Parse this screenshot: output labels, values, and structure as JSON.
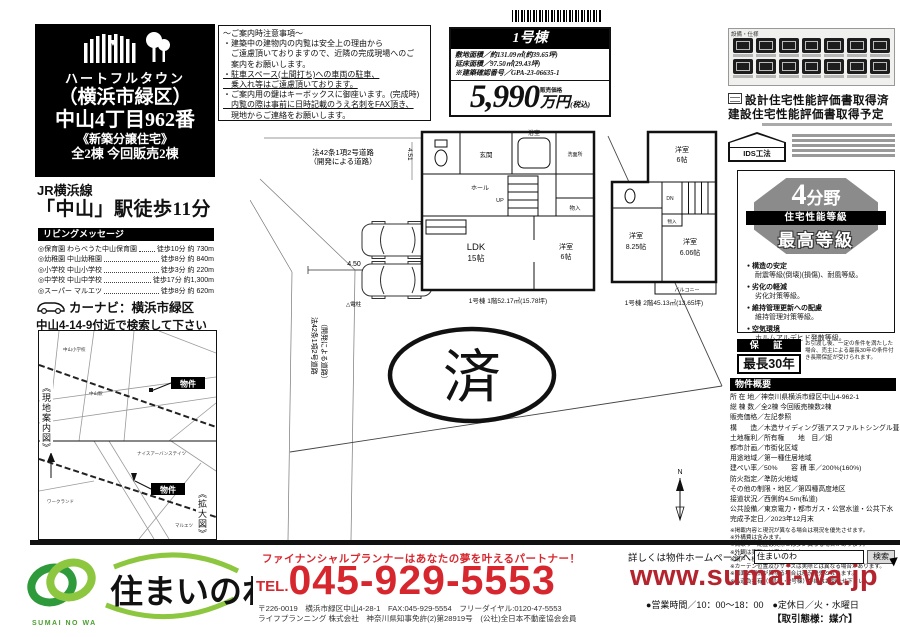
{
  "colors": {
    "accent_red": "#d7272e",
    "url_red": "#b3242e",
    "logo_green_dark": "#2f9a3c",
    "logo_green_light": "#8dc63f"
  },
  "title": {
    "brand": "ハートフルタウン",
    "l1": "（横浜市緑区）",
    "l2": "中山4丁目962番",
    "l3": "《新築分譲住宅》",
    "l4": "全2棟 今回販売2棟"
  },
  "access": {
    "line": "JR横浜線",
    "station": "「中山」駅徒歩11分"
  },
  "living": {
    "header": "リビングメッセージ",
    "items": [
      {
        "name": "◎保育園 わらべうた中山保育園",
        "val": "徒歩10分 約 730m"
      },
      {
        "name": "◎幼稚園 中山幼稚園",
        "val": "徒歩8分 約 840m"
      },
      {
        "name": "◎小学校 中山小学校",
        "val": "徒歩3分 約 220m"
      },
      {
        "name": "◎中学校 中山中学校",
        "val": "徒歩17分 約1,300m"
      },
      {
        "name": "◎スーパー マルエツ",
        "val": "徒歩8分 約 620m"
      }
    ]
  },
  "carnavi": {
    "l1": "カーナビ：横浜市緑区",
    "l2": "中山4-14-9付近で検索して下さい"
  },
  "map": {
    "side_label": "《現地案内図》",
    "zoom_label": "《拡大図》",
    "tag": "物件",
    "north": "N",
    "station": "中山駅",
    "school": "中山小学校",
    "super": "マルエツ",
    "work": "ワークランド",
    "mansion": "ナイスアーバンステイツ"
  },
  "notice": {
    "lines": [
      "～ご案内時注意事項～",
      "・建築中の建物内の内覧は安全上の理由から",
      "　ご遠慮頂いておりますので、近隣の完成現場へのご",
      "　案内をお願いします。",
      "・駐車スペース(土間打ち)への車両の駐車、",
      "　乗入れ等はご遠慮頂いております。",
      "・ご案内用の鍵はキーボックスに御座います。(完成時)",
      "　内覧の際は事前に日時記載のうえ名刺をFAX頂き、",
      "　現地からご連絡をお願いします。"
    ]
  },
  "price": {
    "unit": "1号棟",
    "land": "敷地面積／約131.09㎡(約39.65坪)",
    "bldg": "延床面積／97.50㎡(29.43坪)",
    "confirm": "※建築確認番号／GPA-23-06635-1",
    "label": "販売価格",
    "main": "5,990",
    "unit_yen": "万円",
    "tax": "(税込)"
  },
  "equip": {
    "header": "設備・仕様"
  },
  "perf": {
    "line1": "設計住宅性能評価書取得済",
    "line2": "建設住宅性能評価書取得予定",
    "ids": "IDS工法"
  },
  "perfbox": {
    "field_num": "4",
    "field_suf": "分野",
    "band": "住宅性能等級",
    "rank": "最高等級",
    "bullets": [
      {
        "t": "構造の安定",
        "d": "耐震等級(倒壊)(損傷)、耐風等級。"
      },
      {
        "t": "劣化の軽減",
        "d": "劣化対策等級。"
      },
      {
        "t": "維持管理更新への配慮",
        "d": "維持管理対策等級。"
      },
      {
        "t": "空気環境",
        "d": "ホルムアルデヒド発散等級。"
      }
    ]
  },
  "warranty": {
    "head": "保 証",
    "term": "最長30年",
    "note": "お引渡し後、一定の条件を満たした場合、売主による最長30年の条件付き長期保証が受けられます。"
  },
  "overview": {
    "header": "物件概要",
    "lines": [
      "所 在 地／神奈川県横浜市緑区中山4-962-1",
      "総 棟 数／全2棟 今回販売棟数2棟",
      "販売価格／左記参照",
      "構　　造／木造サイディング張アスファルトシングル葺2階建",
      "土地権利／所有権　　地　目／畑",
      "都市計画／市街化区域",
      "用途地域／第一種住居地域",
      "建ぺい率／50%　　容 積 率／200%(160%)",
      "防火指定／準防火地域",
      "その他の制限・地区／第四種高度地区",
      "接道状況／西側約4.5m(私道)",
      "公共設備／東京電力・都市ガス・公営水道・公共下水",
      "完成予定日／2023年12月末"
    ],
    "notes": [
      "※掲載内容と現況が異なる場合は現況を優先させます。",
      "※外構費は含みます。",
      "※間取り・配置は実際とは多少異なる場合があります。",
      "※外観は実際とは異なります。",
      "※網戸・植栽及び柵は価格に含まれておりません。",
      "※カーテン位置及びサイズは実際とは異なる場合があります。",
      "※図面と現況が異なる場合は現況優先となります。",
      "※私道負担有（1号棟・2号棟）詳細はお問合せ下さい。"
    ]
  },
  "siteplan": {
    "road_top1": "法42条1項2号道路",
    "road_top2": "（開発による道路）",
    "road_left1": "法42条1項2号道路",
    "road_left2": "（開発による道路）",
    "dim_h": "4.50",
    "dim_v": "4.51",
    "pole": "△電柱",
    "stamp": "済",
    "north": "N"
  },
  "plan1f": {
    "genkan": "玄関",
    "bath": "浴室",
    "wash": "洗面所",
    "hall": "ホール",
    "up": "UP",
    "closet": "物入",
    "ldk": "LDK",
    "ldk_size": "15帖",
    "west": "洋室",
    "west_size": "6帖",
    "caption": "1号棟 1階52.17㎡(15.78坪)"
  },
  "plan2f": {
    "r1": "洋室",
    "r1s": "6帖",
    "r2": "洋室",
    "r2s": "8.25帖",
    "r3": "洋室",
    "r3s": "6.06帖",
    "dn": "DN",
    "closet": "物入",
    "balcony": "バルコニー",
    "caption": "1号棟 2階45.13㎡(13.65坪)"
  },
  "footer": {
    "slogan": "ファイナンシャルプランナーはあなたの夢を叶えるパートナー！",
    "tel_label": "TEL.",
    "tel": "045-929-5553",
    "addr1": "〒226-0019　横浜市緑区中山4-28-1　FAX:045-929-5554　フリーダイヤル:0120-47-5553",
    "addr2": "ライフプランニング 株式会社　神奈川県知事免許(2)第28919号　(公社)全日本不動産協会会員",
    "hp_label": "詳しくは物件ホームページへ",
    "search_value": "住まいのわ",
    "search_button": "検索",
    "url": "www.sumai-wa.jp",
    "hours": "●営業時間／10：00～18：00　●定休日／火・水曜日",
    "deal": "【取引態様：媒介】",
    "logo_text": "住まいのわ",
    "logo_sub": "SUMAI NO WA"
  }
}
